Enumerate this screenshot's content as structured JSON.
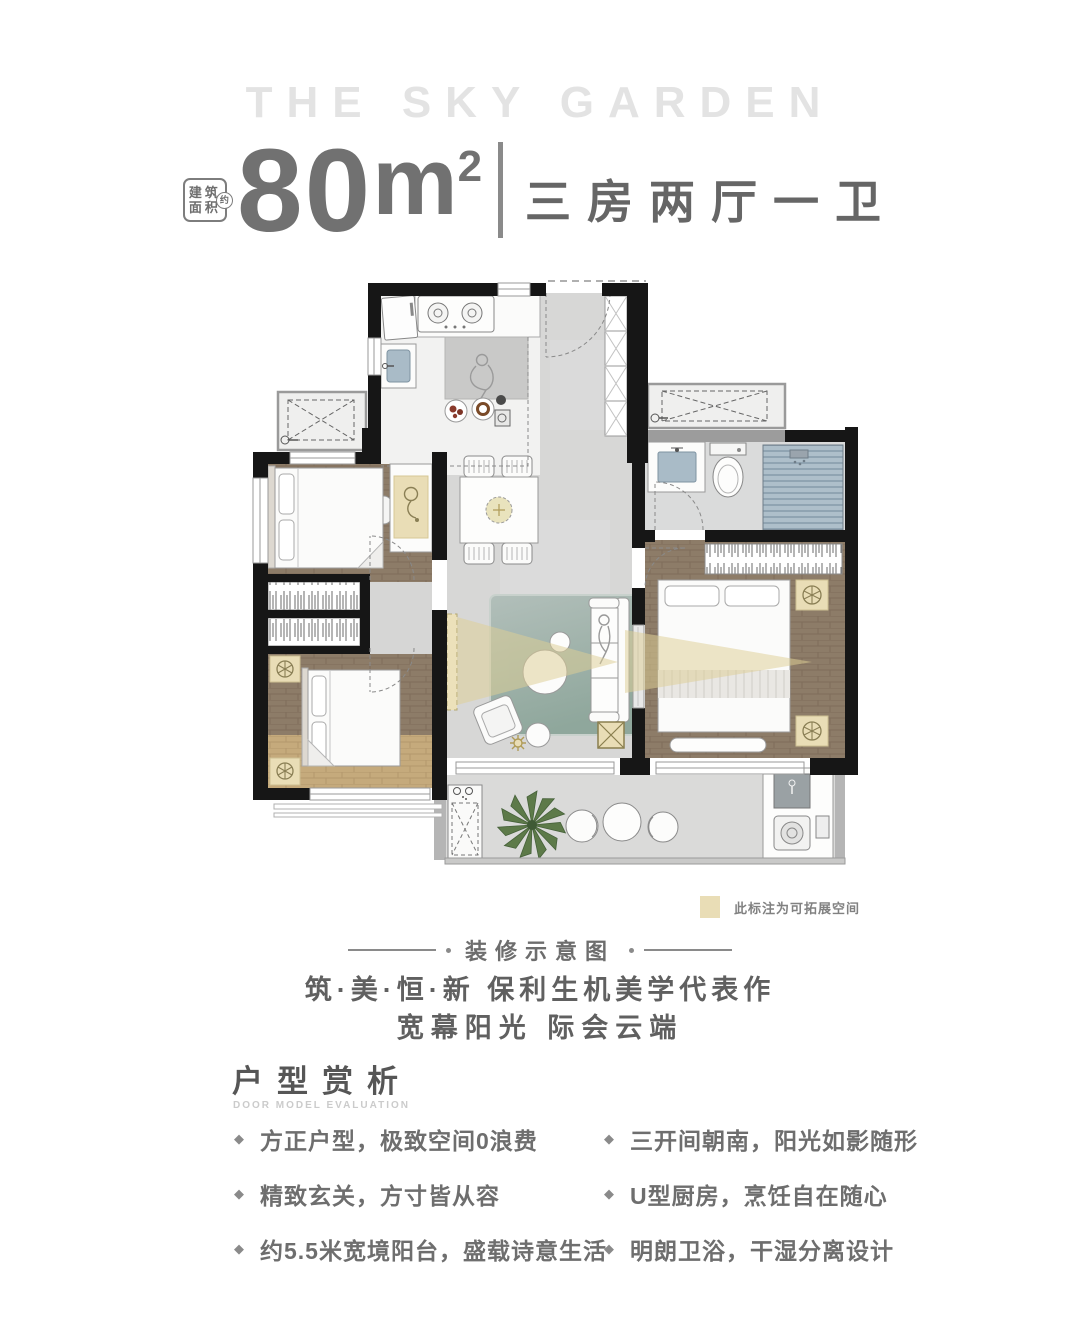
{
  "header": {
    "brand": "THE SKY GARDEN"
  },
  "area": {
    "badge": {
      "line1": "建筑",
      "line2": "面积",
      "circle": "约"
    },
    "value": "80",
    "unit_base": "m",
    "unit_sup": "2",
    "rooms": "三房两厅一卫"
  },
  "floorplan": {
    "legend": {
      "swatch_color": "#e9ddb6",
      "label": "此标注为可拓展空间"
    }
  },
  "caption": {
    "band_title": "装修示意图",
    "slogan1": "筑·美·恒·新 保利生机美学代表作",
    "slogan2": "宽幕阳光 际会云端"
  },
  "analysis": {
    "title": "户型赏析",
    "subtitle": "DOOR MODEL EVALUATION",
    "bullet_marker": "◆",
    "left": [
      "方正户型，极致空间0浪费",
      "精致玄关，方寸皆从容",
      "约5.5米宽境阳台，盛载诗意生活"
    ],
    "right": [
      "三开间朝南，阳光如影随形",
      "U型厨房，烹饪自在随心",
      "明朗卫浴，干湿分离设计"
    ]
  },
  "colors": {
    "wall": "#161616",
    "hall_floor": "#d7d7d6",
    "wood_dark": "#8d7c68",
    "wood_light": "#c8ac7d",
    "beige_expandable": "#e9ddb6",
    "rug": "#a3b3ad",
    "shower_blue": "#aebfca",
    "cone": "#decf96"
  }
}
